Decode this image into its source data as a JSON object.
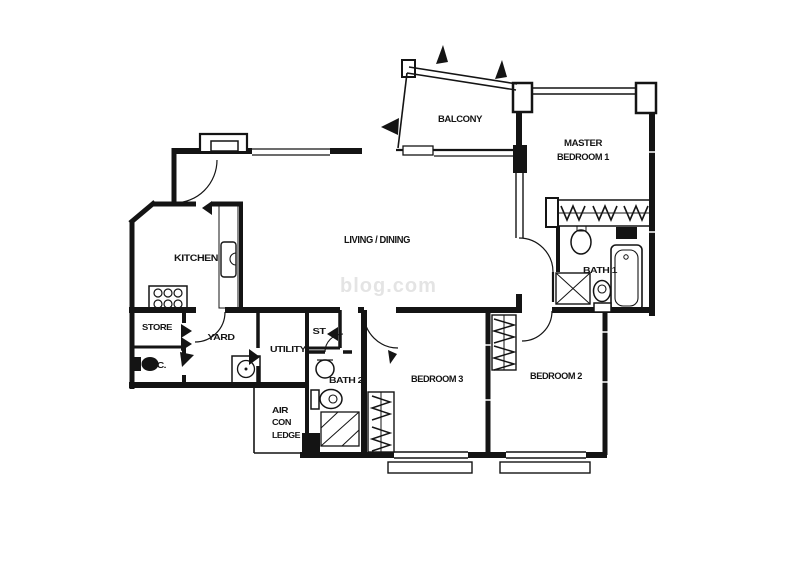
{
  "meta": {
    "title": "Apartment floor plan",
    "canvas_width": 800,
    "canvas_height": 566
  },
  "colors": {
    "ink": "#141414",
    "background": "#ffffff",
    "watermark": "#cfcfcf"
  },
  "watermark": {
    "text": "blog.com"
  },
  "rooms": [
    {
      "id": "balcony",
      "label": "BALCONY"
    },
    {
      "id": "master-bedroom-1",
      "label_lines": [
        "MASTER",
        "BEDROOM 1"
      ]
    },
    {
      "id": "living-dining",
      "label": "LIVING / DINING"
    },
    {
      "id": "kitchen",
      "label": "KITCHEN"
    },
    {
      "id": "store",
      "label": "STORE"
    },
    {
      "id": "wc",
      "label": "W.C."
    },
    {
      "id": "yard",
      "label": "YARD"
    },
    {
      "id": "utility",
      "label": "UTILITY"
    },
    {
      "id": "st-closet",
      "label": "ST"
    },
    {
      "id": "bath-2",
      "label": "BATH 2"
    },
    {
      "id": "air-con-ledge",
      "label_lines": [
        "AIR",
        "CON",
        "LEDGE"
      ]
    },
    {
      "id": "bedroom-3",
      "label": "BEDROOM 3"
    },
    {
      "id": "bedroom-2",
      "label": "BEDROOM 2"
    },
    {
      "id": "bath-1",
      "label": "BATH 1"
    }
  ],
  "fixtures": [
    "entry-door",
    "kitchen-door",
    "stove",
    "kitchen-sink",
    "yard-door",
    "yard-sink",
    "store-door-chevrons",
    "wc-toilet",
    "wc-door-flag",
    "utility-door-chevrons",
    "st-door-chevron",
    "bath2-door",
    "bath2-basin",
    "bath2-toilet",
    "bath2-shower",
    "service-shaft-2",
    "air-con-ledge-slab",
    "bedroom3-door",
    "bedroom3-wardrobe",
    "bedroom3-window",
    "bedroom2-door",
    "bedroom2-wardrobe",
    "bedroom2-window",
    "master-door",
    "master-wardrobe",
    "master-window",
    "balcony-planter-flags",
    "bath1-basin",
    "bath1-toilet",
    "bath1-bathtub",
    "bath1-shower",
    "service-shaft-1"
  ]
}
